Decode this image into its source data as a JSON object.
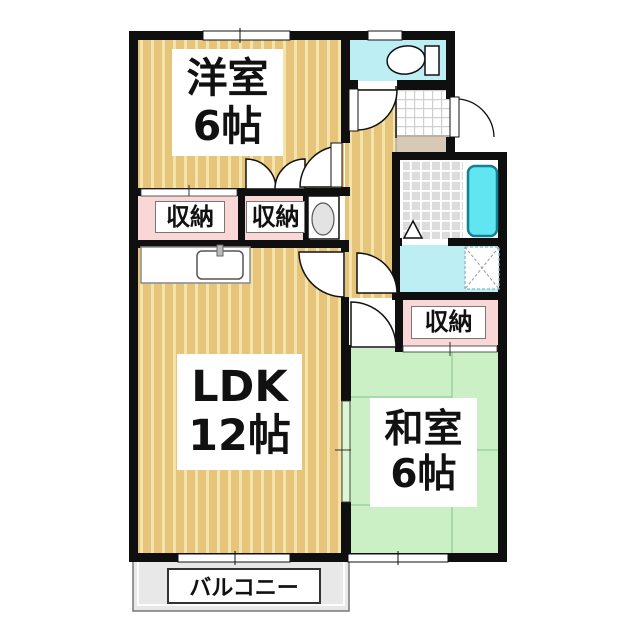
{
  "rooms": {
    "western_room": {
      "label_line1": "洋室",
      "label_line2": "6帖"
    },
    "ldk": {
      "label_line1": "LDK",
      "label_line2": "12帖"
    },
    "japanese_room": {
      "label_line1": "和室",
      "label_line2": "6帖"
    },
    "storage_1": {
      "label": "収納"
    },
    "storage_2": {
      "label": "収納"
    },
    "storage_3": {
      "label": "収納"
    },
    "balcony": {
      "label": "バルコニー"
    }
  },
  "fixtures": {
    "toilet": "toilet-icon",
    "bathtub": "bathtub-icon",
    "kitchen_sink": "kitchen-sink-icon",
    "vanity_basin": "vanity-basin-icon",
    "washer_pan": "washer-pan-icon"
  },
  "colors": {
    "wood": "#e6c479",
    "woodStripe": "#f3e4ae",
    "tatami": "#cbf0c5",
    "tatamiLine": "#9bd39b",
    "closetPink": "#f9d7d7",
    "waterCyan": "#bceef4",
    "tubCyan": "#5fe6f0",
    "tileGray": "#dcdcdc",
    "stepBeige": "#d8c9b7",
    "balconyGray": "#e8e8e8",
    "wall": "#0f0f0f"
  }
}
